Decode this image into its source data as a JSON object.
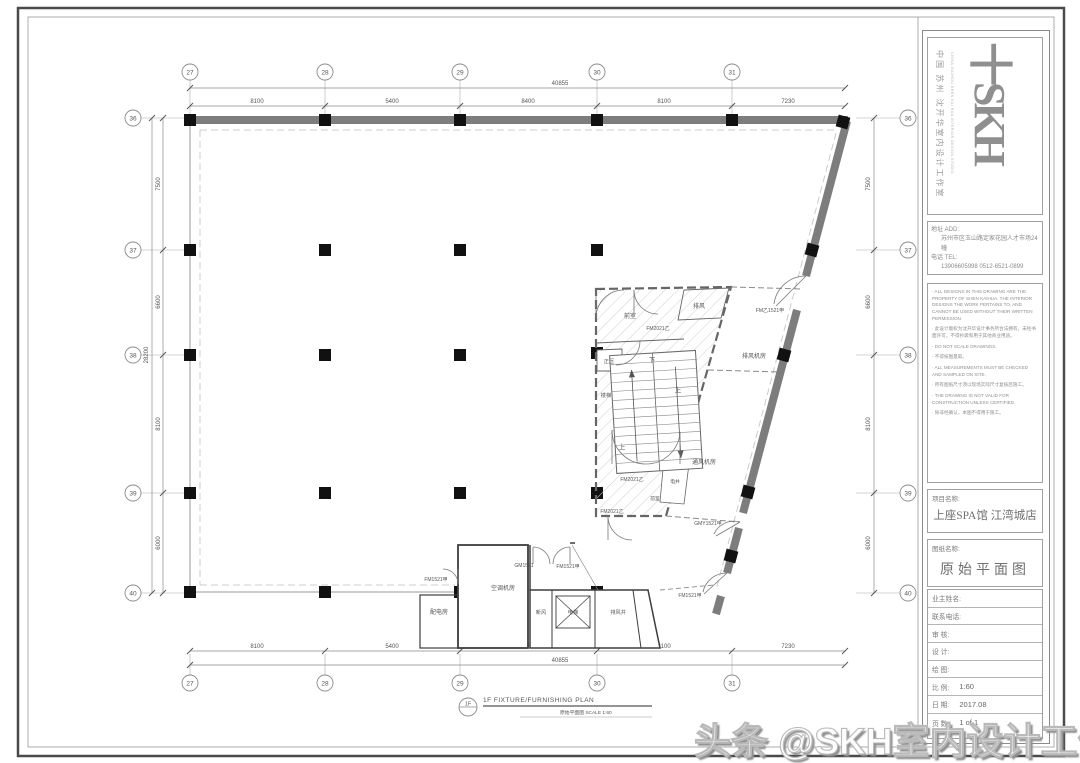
{
  "titleblock": {
    "logo_text": "十SKH",
    "logo_cn": "中国 苏州 沈开华室内设计工作室",
    "logo_en": "CHINA SUZHOU SHEN KAI HUA INTERIOR DESIGN STUDIO",
    "addr_label": "地址 ADD:",
    "addr_value": "苏州市区玉山路定家花园人才市场24幢",
    "tel_label": "电话 TEL:",
    "tel_value": "13906605998    0512-6521-0899",
    "notes": [
      "· ALL DESIGNS IN THIS DRAWING ARE THE PROPERTY OF SHEN KAIHUA. THE INTERIOR DESIGNS THE WORK PERTAINS TO, AND CANNOT BE USED WITHOUT THEIR WRITTEN PERMISSION.",
      "· 此设计版权为沈开华设计事务所合法拥有，未经书面许可，不得抄袭和用于其他商业用途。",
      "· DO NOT SCALE DRAWINGS.",
      "· 不得按图量取。",
      "· ALL MEASUREMENTS MUST BE CHECKED AND SAMPLED ON SITE.",
      "· 所有图纸尺寸须以现场实际尺寸复核后施工。",
      "· THE DRAWING IS NOT VALID FOR CONSTRUCTION UNLESS CERTIFIED.",
      "· 除非经确认，本图不得用于施工。"
    ],
    "project_label": "项目名称:",
    "project_name": "上座SPA馆 江湾城店",
    "drawing_label": "图纸名称:",
    "drawing_name": "原始平面图",
    "fields": [
      {
        "label": "业主姓名:",
        "value": ""
      },
      {
        "label": "联系电话:",
        "value": ""
      },
      {
        "label": "审    核:",
        "value": ""
      },
      {
        "label": "设    计:",
        "value": ""
      },
      {
        "label": "绘    图:",
        "value": ""
      },
      {
        "label": "比    例:",
        "value": "1:60"
      },
      {
        "label": "日    期:",
        "value": "2017.08"
      },
      {
        "label": "页    数:",
        "value": "1 of 1"
      }
    ]
  },
  "caption": {
    "bubble": "1F",
    "title": "1F FIXTURE/FURNISHING PLAN",
    "subtitle": "原始平面图    SCALE 1:60"
  },
  "watermark": {
    "text": "头条 @SKH室内设计工作室"
  },
  "grid": {
    "cols": [
      "27",
      "28",
      "29",
      "30",
      "31"
    ],
    "rows": [
      "36",
      "37",
      "38",
      "39",
      "40"
    ]
  },
  "dims": {
    "top_total": "40855",
    "top_segments": [
      "8100",
      "5400",
      "8400",
      "8100",
      "7230"
    ],
    "bottom_total": "40855",
    "bottom_segments": [
      "8100",
      "5400",
      "8400",
      "8100",
      "7230"
    ],
    "left_total": "28200",
    "left_segments": [
      "7500",
      "6600",
      "8100",
      "6000"
    ],
    "right_segments": [
      "7500",
      "6600",
      "8100",
      "6000"
    ]
  },
  "rooms": {
    "qianshi1": "前室",
    "paifeng": "排风",
    "paifengjifang": "排风机房",
    "zhengya": "正压",
    "louti": "楼梯",
    "tongfengjifang": "通风机房",
    "dianjing": "电井",
    "qianshi2": "前室",
    "kongtiaojifang": "空调机房",
    "peidianfang": "配电房",
    "xinfeng": "新风",
    "dianti": "电梯",
    "paifengjing": "排风井",
    "up": "上",
    "down": "下"
  },
  "doors": {
    "fm2021": "FM2021乙",
    "fm1521": "FM1521甲",
    "gm1521": "GM1521",
    "gmy1521": "GMY1521甲",
    "fmy1521": "FM乙1521甲"
  }
}
